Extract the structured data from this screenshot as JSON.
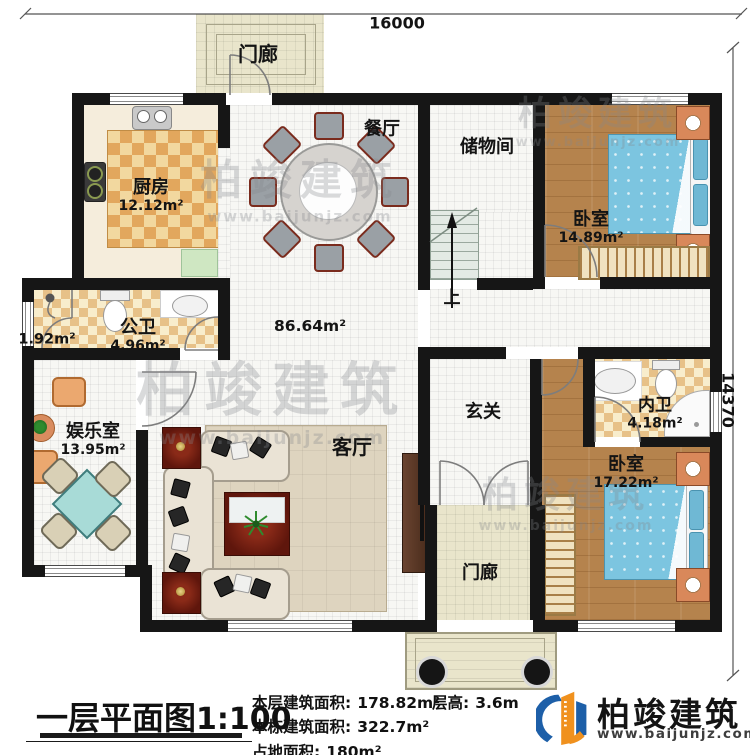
{
  "plan": {
    "dimensions": {
      "width": "16000",
      "height": "14370"
    },
    "rooms": {
      "porch_top": {
        "name": "门廊"
      },
      "kitchen": {
        "name": "厨房",
        "area": "12.12m²"
      },
      "dining": {
        "name": "餐厅"
      },
      "storage": {
        "name": "储物间"
      },
      "bedroom1": {
        "name": "卧室",
        "area": "14.89m²"
      },
      "bath_small": {
        "area": "1.92m²"
      },
      "public_bath": {
        "name": "公卫",
        "area": "4.96m²"
      },
      "entertainment": {
        "name": "娱乐室",
        "area": "13.95m²"
      },
      "hall": {
        "area": "86.64m²"
      },
      "living": {
        "name": "客厅"
      },
      "foyer": {
        "name": "玄关"
      },
      "inner_bath": {
        "name": "内卫",
        "area": "4.18m²"
      },
      "bedroom2": {
        "name": "卧室",
        "area": "17.22m²"
      },
      "porch_bottom": {
        "name": "门廊"
      },
      "stairs": {
        "label": "上"
      }
    }
  },
  "footer": {
    "title": "一层平面图",
    "scale": "1:100",
    "stats": [
      {
        "label": "本层建筑面积:",
        "value": "178.82m²"
      },
      {
        "label": "本栋建筑面积:",
        "value": "322.7m²"
      },
      {
        "label": "占地面积:",
        "value": "180m²"
      }
    ],
    "floor_height": {
      "label": "层高:",
      "value": "3.6m"
    },
    "brand": {
      "name": "柏竣建筑",
      "website": "www.baijunjz.com"
    }
  },
  "watermark": {
    "text": "柏竣建筑",
    "url": "www.baijunjz.com"
  },
  "colors": {
    "wall": "#161616",
    "wood": "#b5834d",
    "bed": "#7cc5e0",
    "brand_blue": "#1d5fa8",
    "brand_orange": "#f0911e"
  }
}
